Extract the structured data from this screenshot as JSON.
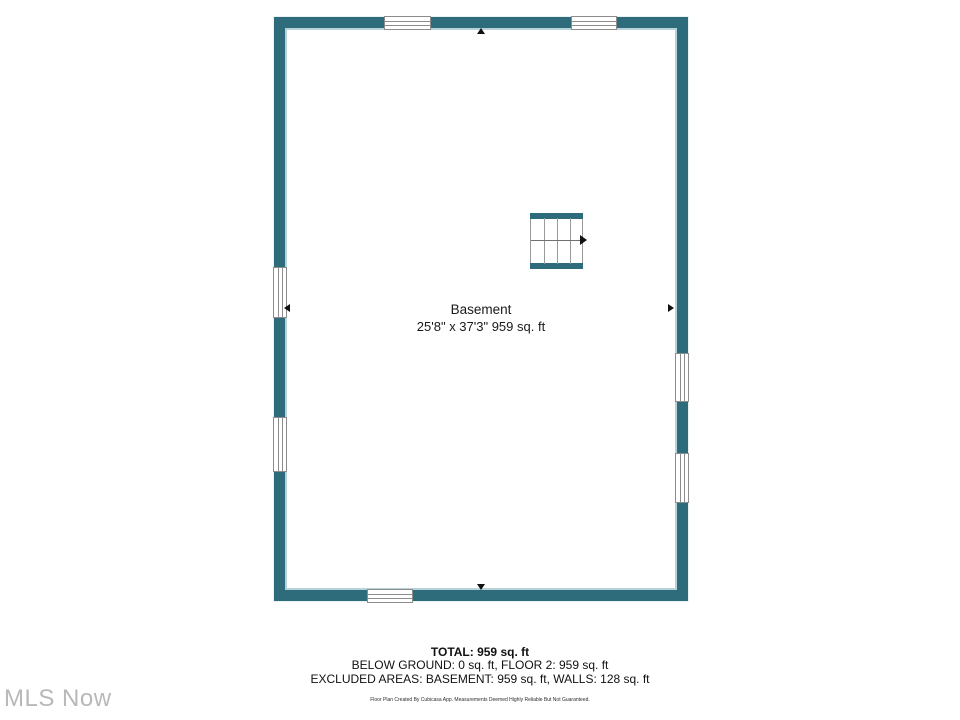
{
  "floorplan": {
    "room": {
      "name": "Basement",
      "dimensions": "25'8\" x 37'3\" 959 sq. ft"
    },
    "summary": {
      "total": "TOTAL: 959 sq. ft",
      "below_ground": "BELOW GROUND: 0 sq. ft, FLOOR 2: 959 sq. ft",
      "excluded": "EXCLUDED AREAS: BASEMENT: 959 sq. ft, WALLS: 128 sq. ft",
      "disclaimer": "Floor Plan Created By Cubicasa App. Measurements Deemed Highly Reliable But Not Guaranteed."
    },
    "watermark": "MLS Now",
    "colors": {
      "wall": "#2E6C7C",
      "wall_inner_edge": "#B7D3D9",
      "window_frame": "#8C8C8C",
      "stair_line": "#9A9A9A",
      "text": "#1A1A1A",
      "watermark": "#B8B8B8"
    }
  }
}
